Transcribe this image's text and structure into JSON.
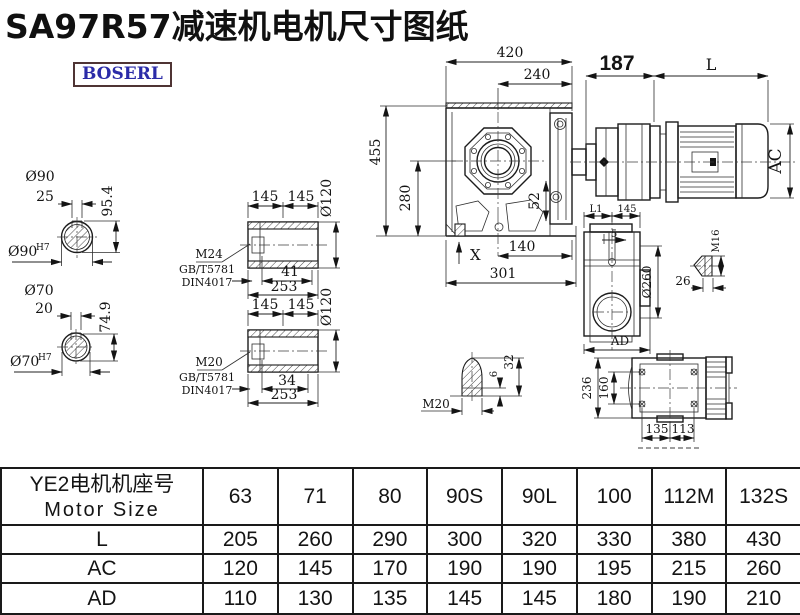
{
  "title": "SA97R57减速机电机尺寸图纸",
  "logo_text": "BOSERL",
  "colors": {
    "logo_text": "#2b2ba8",
    "logo_border": "#4f3434",
    "line": "#1c1c1c",
    "background": "#ffffff"
  },
  "labels": {
    "dim_420": "420",
    "dim_240": "240",
    "dim_187": "187",
    "dim_L": "L",
    "dim_455": "455",
    "dim_280": "280",
    "dim_52": "52",
    "dim_140": "140",
    "dim_301": "301",
    "dim_X": "X",
    "dim_AC": "AC",
    "d90": "Ø90",
    "sup_h7": "H7",
    "dim_25": "25",
    "dim_95_4": "95.4",
    "d70": "Ø70",
    "dim_20": "20",
    "dim_74_9": "74.9",
    "dim_145": "145",
    "d120": "Ø120",
    "m24": "M24",
    "gb": "GB/T5781",
    "din": "DIN4017",
    "dim_41": "41",
    "dim_253": "253",
    "m20": "M20",
    "dim_34": "34",
    "l1": "L1",
    "dim_5": "5",
    "d260": "Ø260",
    "ad": "AD",
    "m16": "M16",
    "dim_26": "26",
    "dim_6": "6",
    "dim_32": "32",
    "dim_236": "236",
    "dim_160": "160",
    "dim_135": "135",
    "dim_113": "113"
  },
  "table": {
    "header": {
      "cn": "YE2电机机座号",
      "en": "Motor Size"
    },
    "columns": [
      "63",
      "71",
      "80",
      "90S",
      "90L",
      "100",
      "112M",
      "132S"
    ],
    "rows": [
      {
        "label": "L",
        "values": [
          "205",
          "260",
          "290",
          "300",
          "320",
          "330",
          "380",
          "430"
        ]
      },
      {
        "label": "AC",
        "values": [
          "120",
          "145",
          "170",
          "190",
          "190",
          "195",
          "215",
          "260"
        ]
      },
      {
        "label": "AD",
        "values": [
          "110",
          "130",
          "135",
          "145",
          "145",
          "180",
          "190",
          "210"
        ]
      }
    ]
  }
}
